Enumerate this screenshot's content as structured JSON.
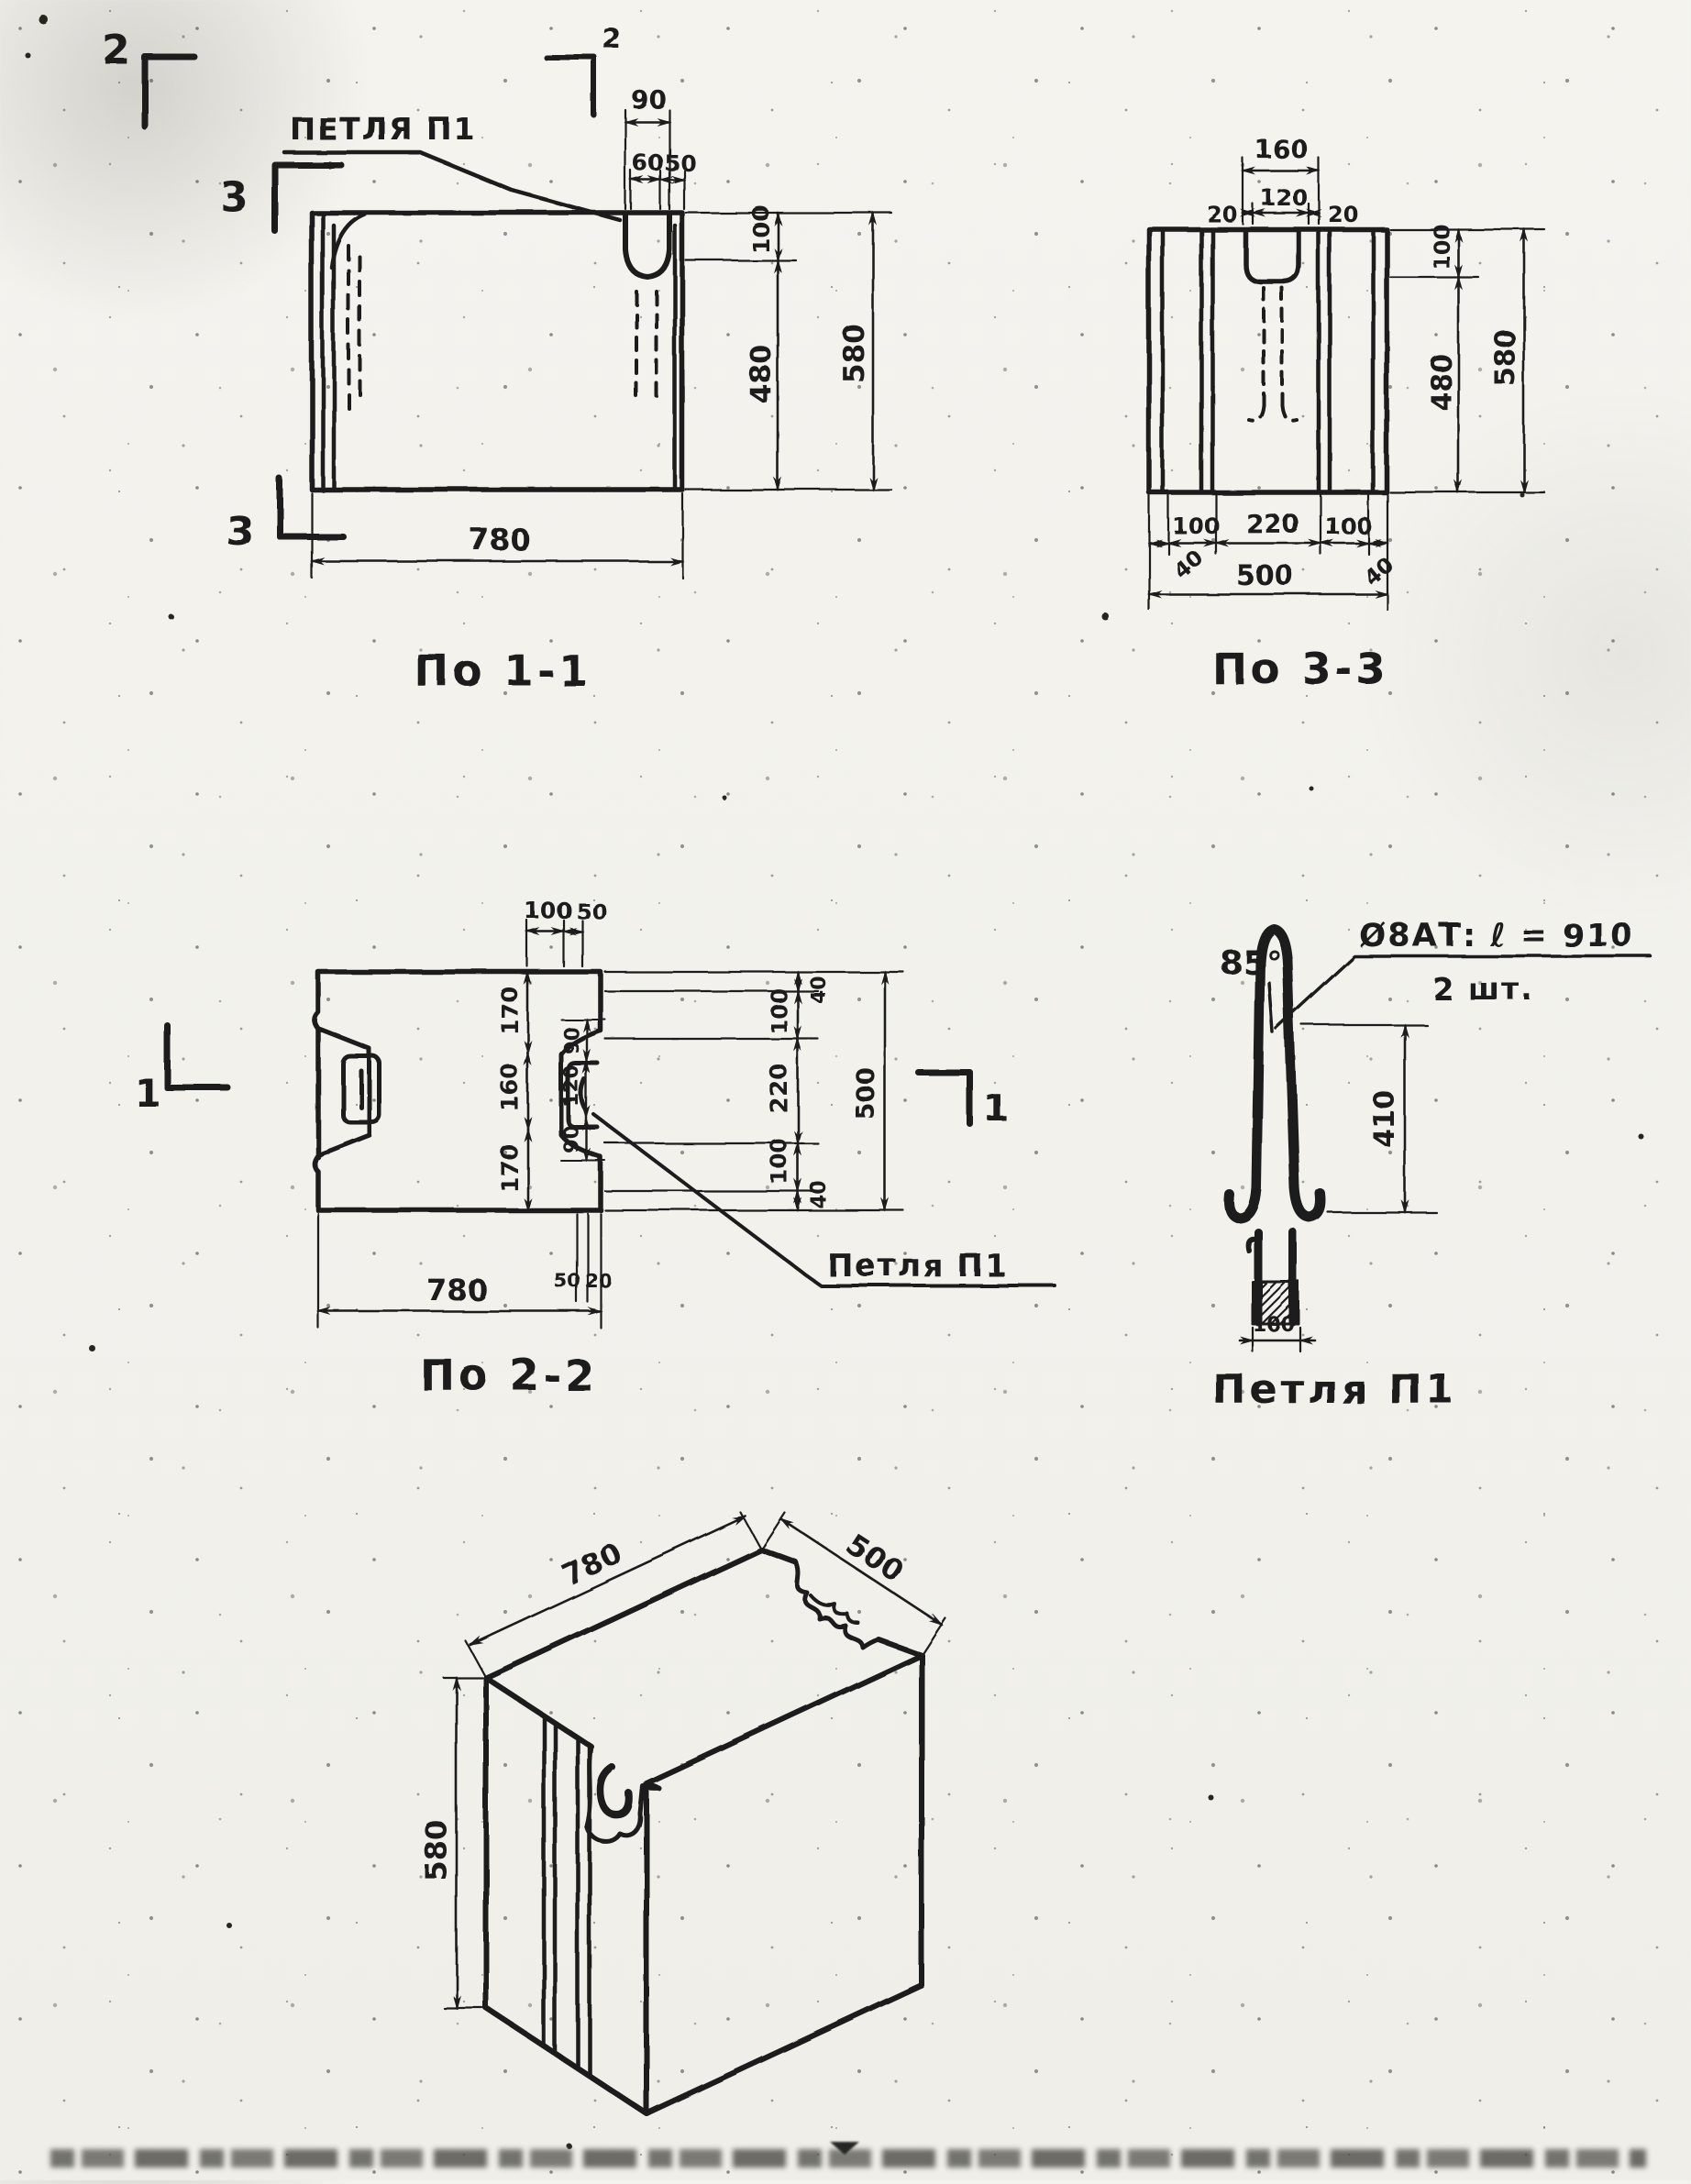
{
  "views": {
    "po11": {
      "caption": "По 1-1",
      "petlya_label": "ПЕТЛЯ П1",
      "marker_2_left": "2",
      "marker_2_right": "2",
      "marker_3_top": "3",
      "marker_3_bottom": "3",
      "dims": {
        "d90": "90",
        "d60": "60",
        "d50": "50",
        "d100": "100",
        "d480": "480",
        "d580": "580",
        "d780": "780"
      }
    },
    "po33": {
      "caption": "По 3-3",
      "dims": {
        "d160": "160",
        "d20l": "20",
        "d120": "120",
        "d20r": "20",
        "d100t": "100",
        "d480": "480",
        "d580": "580",
        "d100l": "100",
        "d220": "220",
        "d100r": "100",
        "d40l": "40",
        "d40r": "40",
        "d500": "500"
      }
    },
    "po22": {
      "caption": "По 2-2",
      "petlya_label": "Петля П1",
      "marker_1_left": "1",
      "marker_1_right": "1",
      "dims": {
        "d100t": "100",
        "d50t": "50",
        "d170a": "170",
        "d160": "160",
        "d170b": "170",
        "d90a": "90",
        "d120": "120",
        "d90b": "90",
        "d40t": "40",
        "d100a": "100",
        "d220": "220",
        "d100b": "100",
        "d40b": "40",
        "d500": "500",
        "d50": "50",
        "d20": "20",
        "d780": "780"
      }
    },
    "p1": {
      "caption": "Петля П1",
      "callout_line1": "Ø8АТ: ℓ = 910",
      "callout_line2": "2 шт.",
      "angle_label": "85°",
      "dims": {
        "d410": "410",
        "d100": "100"
      }
    },
    "iso": {
      "dims": {
        "d780": "780",
        "d500": "500",
        "d580": "580"
      }
    }
  }
}
